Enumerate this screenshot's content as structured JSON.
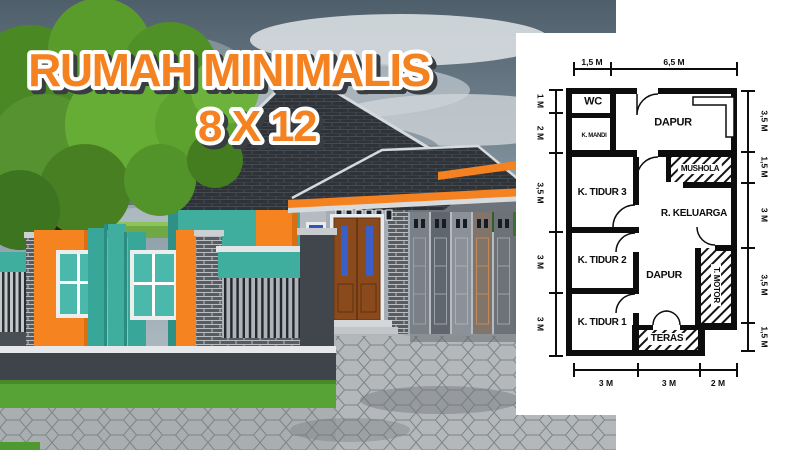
{
  "title": {
    "line1": "RUMAH MINIMALIS",
    "line2": "8 X 12"
  },
  "floorplan": {
    "rooms": {
      "wc": "WC",
      "k_mandi": "K. MANDI",
      "dapur_top": "DAPUR",
      "mushola": "MUSHOLA",
      "k_tidur_3": "K. TIDUR 3",
      "r_keluarga": "R. KELUARGA",
      "k_tidur_2": "K. TIDUR 2",
      "dapur_center": "DAPUR",
      "t_motor": "T. MOTOR",
      "k_tidur_1": "K. TIDUR 1",
      "teras": "TERAS"
    },
    "dims_top": [
      "1,5 M",
      "6,5 M"
    ],
    "dims_left": [
      "1 M",
      "2 M",
      "3,5 M",
      "3 M",
      "3 M"
    ],
    "dims_right": [
      "3,5 M",
      "1,5 M",
      "3 M",
      "3,5 M",
      "1,5 M"
    ],
    "dims_bottom": [
      "3 M",
      "3 M",
      "2 M"
    ]
  },
  "colors": {
    "accent_orange": "#F58220",
    "accent_teal": "#3FAE9F",
    "roof_dark": "#2F3338",
    "sky_dark": "#4E5E6A",
    "grass_green": "#57A335",
    "door_brown": "#8A4A1C",
    "glass_blue": "#3A5FC6",
    "plan_line": "#0D0D0D",
    "panel_white": "#FFFFFF"
  }
}
